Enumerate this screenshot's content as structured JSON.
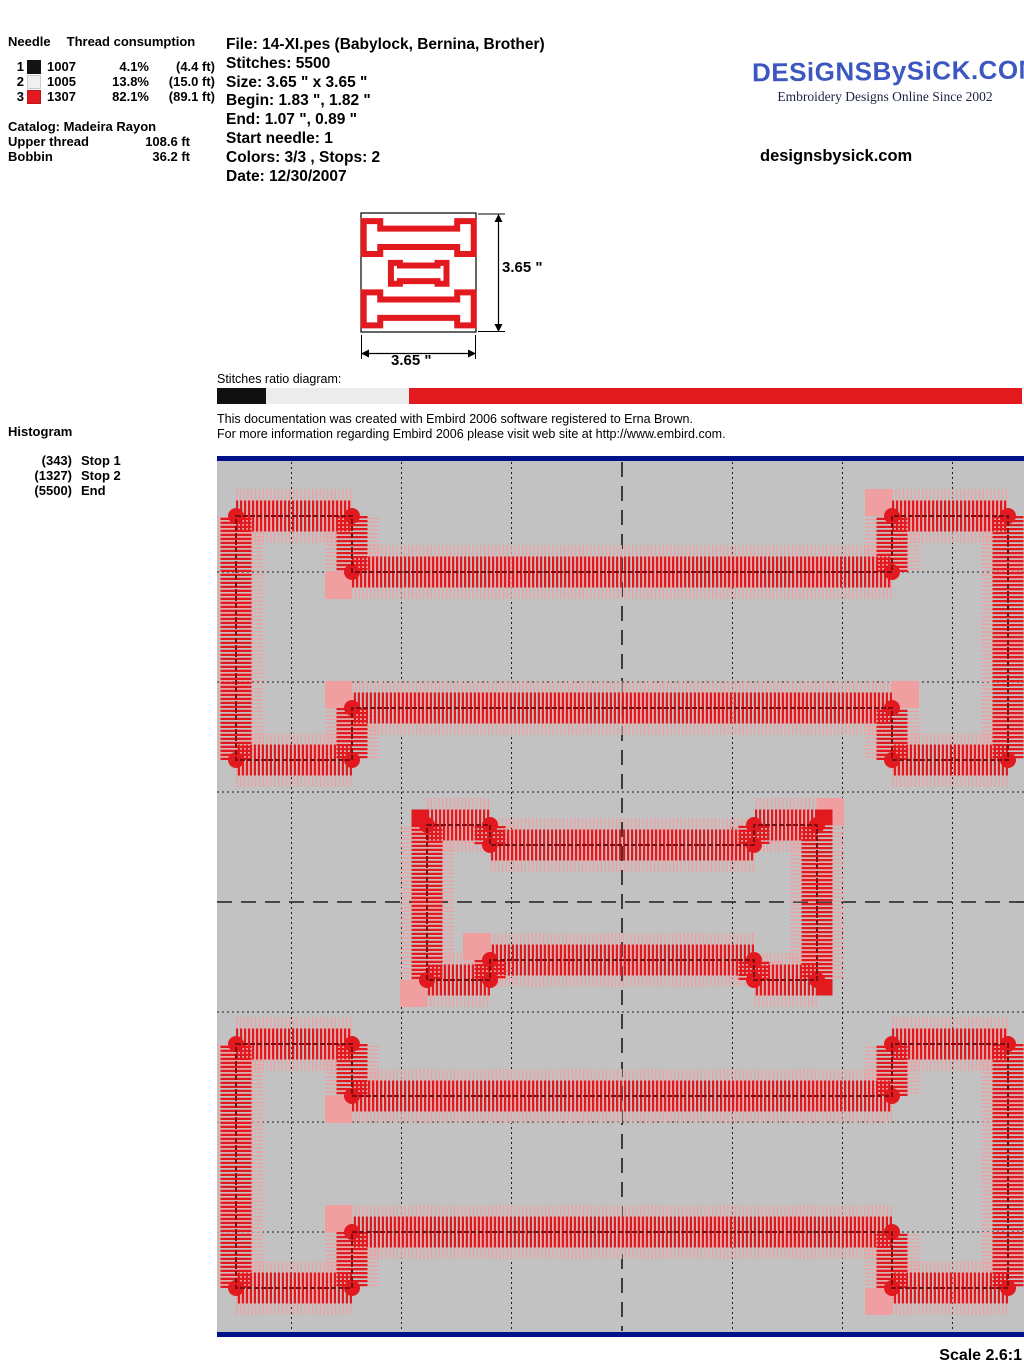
{
  "thread_panel": {
    "header_needle": "Needle",
    "header_consumption": "Thread consumption",
    "rows": [
      {
        "needle": "1",
        "color": "#141414",
        "code": "1007",
        "percent": "4.1%",
        "length": "(4.4 ft)"
      },
      {
        "needle": "2",
        "color": "#f0f0f0",
        "code": "1005",
        "percent": "13.8%",
        "length": "(15.0 ft)"
      },
      {
        "needle": "3",
        "color": "#e2191f",
        "code": "1307",
        "percent": "82.1%",
        "length": "(89.1 ft)"
      }
    ],
    "catalog": "Catalog: Madeira Rayon",
    "upper_label": "Upper thread",
    "upper_value": "108.6 ft",
    "bobbin_label": "Bobbin",
    "bobbin_value": "36.2 ft"
  },
  "file_info": {
    "lines": [
      "File: 14-XI.pes  (Babylock, Bernina, Brother)",
      "Stitches: 5500",
      "Size: 3.65 \" x 3.65 \"",
      "Begin: 1.83 \", 1.82 \"",
      "End: 1.07 \", 0.89 \"",
      "Start needle: 1",
      "Colors: 3/3 , Stops: 2",
      "Date: 12/30/2007"
    ]
  },
  "logo": {
    "title": "DESiGNSBySiCK.COM",
    "tagline": "Embroidery Designs Online Since 2002",
    "site": "designsbysick.com",
    "color": "#3c57c0"
  },
  "thumbnail": {
    "height_label": "3.65 \"",
    "width_label": "3.65 \""
  },
  "ratio": {
    "label": "Stitches ratio diagram:",
    "segments": [
      {
        "color": "#101010",
        "pct": 6.1
      },
      {
        "color": "#ececec",
        "pct": 17.8
      },
      {
        "color": "#e2191f",
        "pct": 76.1
      }
    ]
  },
  "notes": {
    "line1": "This documentation was created with Embird 2006 software registered to Erna Brown.",
    "line2": "For more information regarding Embird 2006 please visit web site at http://www.embird.com."
  },
  "histogram": {
    "title": "Histogram",
    "stops": [
      {
        "count": "(343)",
        "label": "Stop 1"
      },
      {
        "count": "(1327)",
        "label": "Stop 2"
      },
      {
        "count": "(5500)",
        "label": "End"
      }
    ]
  },
  "scale_label": "Scale 2.6:1",
  "design": {
    "colors": {
      "bg": "#c2c2c2",
      "border": "#001189",
      "grid": "#1c1c1c",
      "thread": "#e2191f",
      "fringe": "#f09fa0",
      "core": "#7c0e12"
    },
    "grid": {
      "v_dotted": [
        74.5,
        184.5,
        294.5,
        515.5,
        625.5,
        735.5
      ],
      "v_center": 405,
      "h_dotted": [
        116,
        226,
        336,
        556,
        666,
        776
      ],
      "h_center": 446
    },
    "beams": [
      {
        "x_left": 19,
        "x_inner_left": 135,
        "x_inner_right": 675,
        "x_right": 791,
        "y_cap_top": 60,
        "y_stem_top": 116,
        "y_stem_bottom": 252,
        "y_cap_bottom": 304
      },
      {
        "x_left": 210,
        "x_inner_left": 273,
        "x_inner_right": 537,
        "x_right": 600,
        "y_cap_top": 369,
        "y_stem_top": 389,
        "y_stem_bottom": 504,
        "y_cap_bottom": 524
      },
      {
        "x_left": 19,
        "x_inner_left": 135,
        "x_inner_right": 675,
        "x_right": 791,
        "y_cap_top": 588,
        "y_stem_top": 640,
        "y_stem_bottom": 776,
        "y_cap_bottom": 832
      }
    ]
  }
}
